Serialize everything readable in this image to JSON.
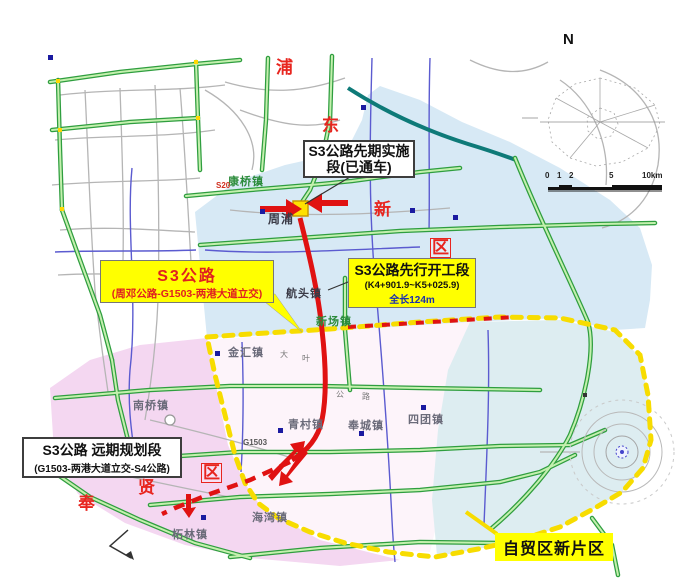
{
  "compass": {
    "north": "N"
  },
  "scalebar": {
    "n0": "0",
    "n1": "1",
    "n2": "2",
    "n5": "5",
    "n10": "10km"
  },
  "callouts": {
    "initial": {
      "text": "S3公路先期实施段(已通车)"
    },
    "advance": {
      "line1": "S3公路先行开工段",
      "line2": "(K4+901.9~K5+025.9)",
      "line3": "全长124m"
    },
    "s3": {
      "line1": "S3公路",
      "line2": "(周邓公路-G1503-两港大道立交)"
    },
    "longterm": {
      "line1": "S3公路 远期规划段",
      "line2": "(G1503-两港大道立交-S4公路)"
    },
    "ftz": {
      "text": "自贸区新片区"
    }
  },
  "districts": {
    "pudong": [
      "浦",
      "东",
      "新",
      "区"
    ],
    "fengxian": [
      "奉",
      "贤",
      "区"
    ]
  },
  "towns": [
    "康桥镇",
    "周浦",
    "航头镇",
    "新场镇",
    "金汇镇",
    "南桥镇",
    "青村镇",
    "奉城镇",
    "四团镇",
    "海湾镇",
    "柘林镇"
  ],
  "road_labels": {
    "g1503": "G1503",
    "s20": "S20",
    "daye": [
      "大",
      "叶",
      "公",
      "路"
    ]
  },
  "colors": {
    "pudong_fill": "#d7e9f5",
    "fengxian_fill": "#f4d7f1",
    "ftz_inner_fill": "#fdf4fa",
    "lingang_fill": "#ddedf1",
    "highway_green": "#2f9e3f",
    "route_red": "#e01212",
    "boundary_yellow": "#f7dc00",
    "callout_yellow": "#ffff00",
    "district_red": "#e8251f"
  }
}
